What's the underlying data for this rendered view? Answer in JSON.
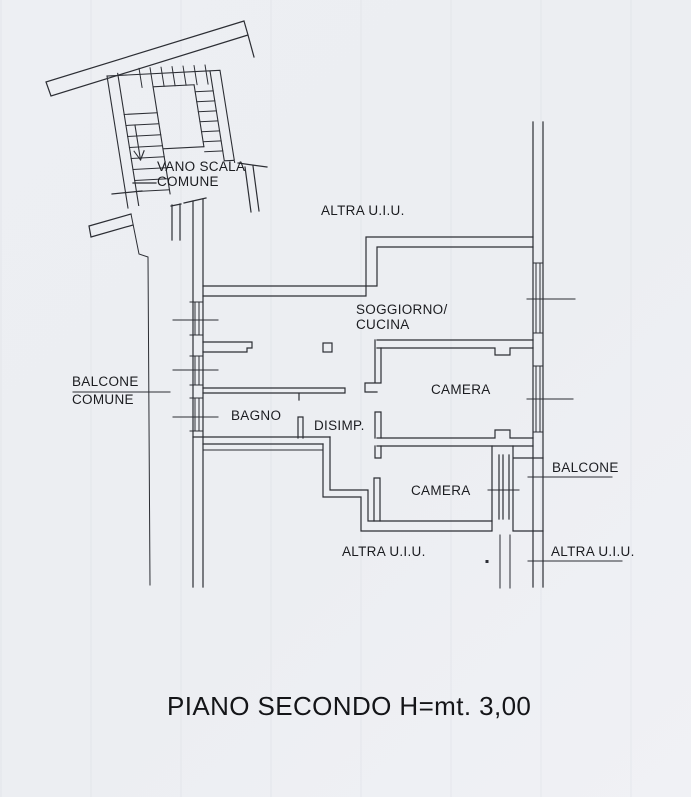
{
  "document": {
    "type": "floor-plan-scan",
    "title": "PIANO SECONDO H=mt. 3,00"
  },
  "colors": {
    "paper": "#edeff3",
    "line": "#2c2e34",
    "text": "#1b1c20"
  },
  "plan": {
    "stairwell": {
      "label_line1": "VANO SCALA",
      "label_line2": "COMUNE",
      "direction_arrow": "down-arrow"
    },
    "rooms": {
      "altra_top": "ALTRA U.I.U.",
      "soggiorno_line1": "SOGGIORNO/",
      "soggiorno_line2": "CUCINA",
      "camera_upper": "CAMERA",
      "camera_lower": "CAMERA",
      "bagno": "BAGNO",
      "disimp": "DISIMP.",
      "balcone_comune_line1": "BALCONE",
      "balcone_comune_line2": "COMUNE",
      "balcone": "BALCONE",
      "altra_bottom_left": "ALTRA U.I.U.",
      "altra_bottom_right": "ALTRA U.I.U."
    }
  }
}
